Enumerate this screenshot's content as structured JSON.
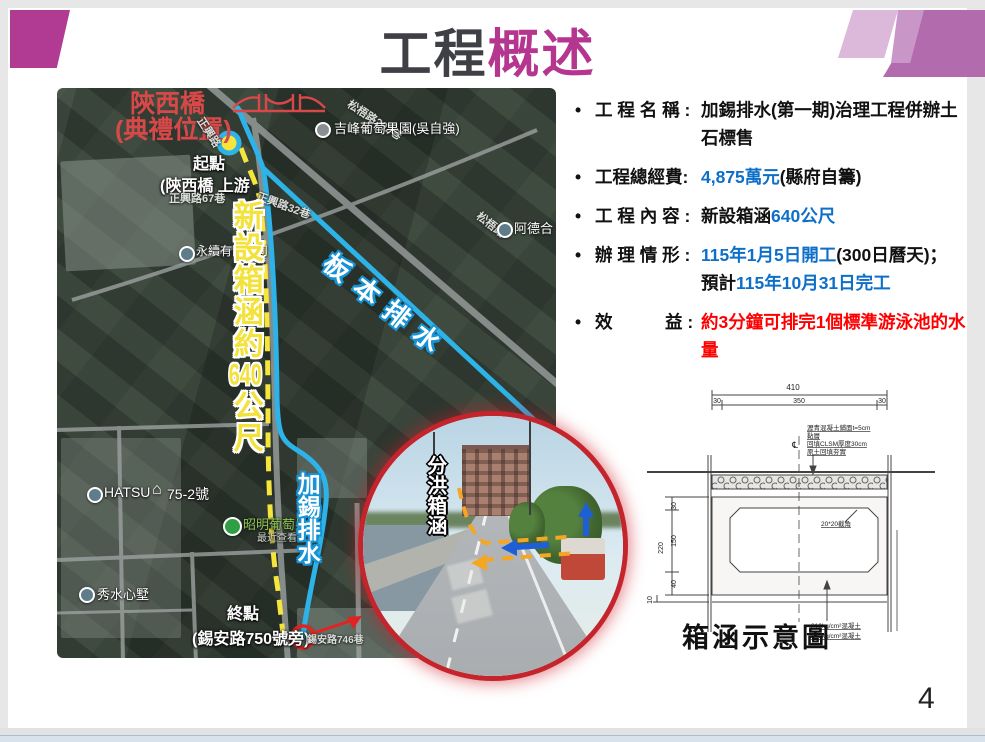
{
  "page": {
    "page_number": "4",
    "bullet_char": "•"
  },
  "title": {
    "black": "工程",
    "magenta": "概述"
  },
  "colors": {
    "accent_magenta": "#b5368f",
    "deco_purple_dark": "#b26cae",
    "deco_purple_light": "#dcb9da",
    "highlight_blue": "#0d6fc8",
    "highlight_red": "#fe0000",
    "map_blue_line": "#2db3e8",
    "map_yellow_dash": "#f6e53c"
  },
  "bullets": [
    {
      "label": "工 程 名 稱 : ",
      "segments": [
        {
          "text": "加錫排水(第一期)治理工程併辦土石標售",
          "color": "black"
        }
      ]
    },
    {
      "label": "工程總經費: ",
      "segments": [
        {
          "text": "4,875萬元",
          "color": "blue"
        },
        {
          "text": "(縣府自籌)",
          "color": "black"
        }
      ]
    },
    {
      "label": "工 程 內 容 : ",
      "segments": [
        {
          "text": "新設箱涵",
          "color": "black"
        },
        {
          "text": "640公尺",
          "color": "blue"
        }
      ]
    },
    {
      "label": "辦 理 情 形 : ",
      "segments": [
        {
          "text": "115年1月5日開工",
          "color": "blue"
        },
        {
          "text": "(300日曆天)；",
          "color": "black"
        },
        {
          "br": true
        },
        {
          "text": "預計",
          "color": "black"
        },
        {
          "text": "115年10月31日完工",
          "color": "blue"
        }
      ]
    },
    {
      "label": "效　　　益 : ",
      "segments": [
        {
          "text": "約3分鐘可排完1個標準游泳池的水量",
          "color": "red"
        }
      ]
    }
  ],
  "map": {
    "labels": {
      "bridge_name": "陝西橋",
      "ceremony": "(典禮位置)",
      "start_point": "起點",
      "start_note": "(陝西橋 上游",
      "road_zhengxing": "正興路",
      "road_292": "松梧路292巷",
      "road_32": "正興路32巷",
      "road_songwu": "松梧路",
      "road_67": "正興路67巷",
      "road_746": "錫安路746巷",
      "poi_jifeng": "吉峰葡萄果園(吳自強)",
      "poi_ade": "阿德合",
      "poi_company": "永續有限公司",
      "poi_hatsu": "HATSU",
      "poi_house": "75-2號",
      "poi_zhaoming": "昭明葡萄果",
      "poi_zhaoming_sub": "最近查看過",
      "poi_xiushui": "秀水心墅",
      "end_point": "終點",
      "end_note": "(錫安路750號旁)",
      "canal_banben": "板本排水",
      "canal_jiaxi": "加錫排水",
      "culvert_line1": "新設箱涵約",
      "culvert_num": "640",
      "culvert_line2": "公尺"
    },
    "icons": {
      "house": "⌂"
    }
  },
  "inset": {
    "label": "分洪箱涵"
  },
  "diagram": {
    "title": "箱涵示意圖",
    "centerline_symbol": "℄",
    "dims": {
      "total_width": "410",
      "edge_left": "30",
      "inner_width": "350",
      "edge_right": "30",
      "height_total": "220",
      "wall_top": "30",
      "inner_height": "150",
      "slab_bottom": "40",
      "base": "10"
    },
    "notes": {
      "pavement": "瀝青混凝土鋪面t=5cm",
      "tack_coat": "黏層",
      "clsm": "回填CLSM厚度30cm",
      "backfill": "原土回填夯實",
      "chamfer": "20*20截角",
      "concrete_top": "210kg/cm²混凝土",
      "concrete_bottom": "140kg/cm²混凝土"
    }
  }
}
